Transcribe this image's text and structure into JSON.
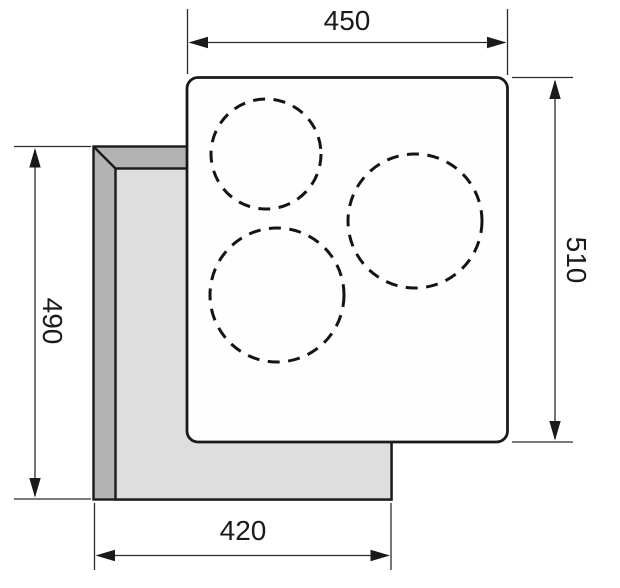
{
  "dims": {
    "top_width": "450",
    "right_height": "510",
    "left_height": "490",
    "bottom_width": "420"
  },
  "colors": {
    "outline": "#1a1a1a",
    "dimension_line": "#2b2b2b",
    "cutout_edge": "#b3b3b3",
    "cutout_face": "#dedede",
    "panel": "#fefefe",
    "background": "#ffffff"
  }
}
